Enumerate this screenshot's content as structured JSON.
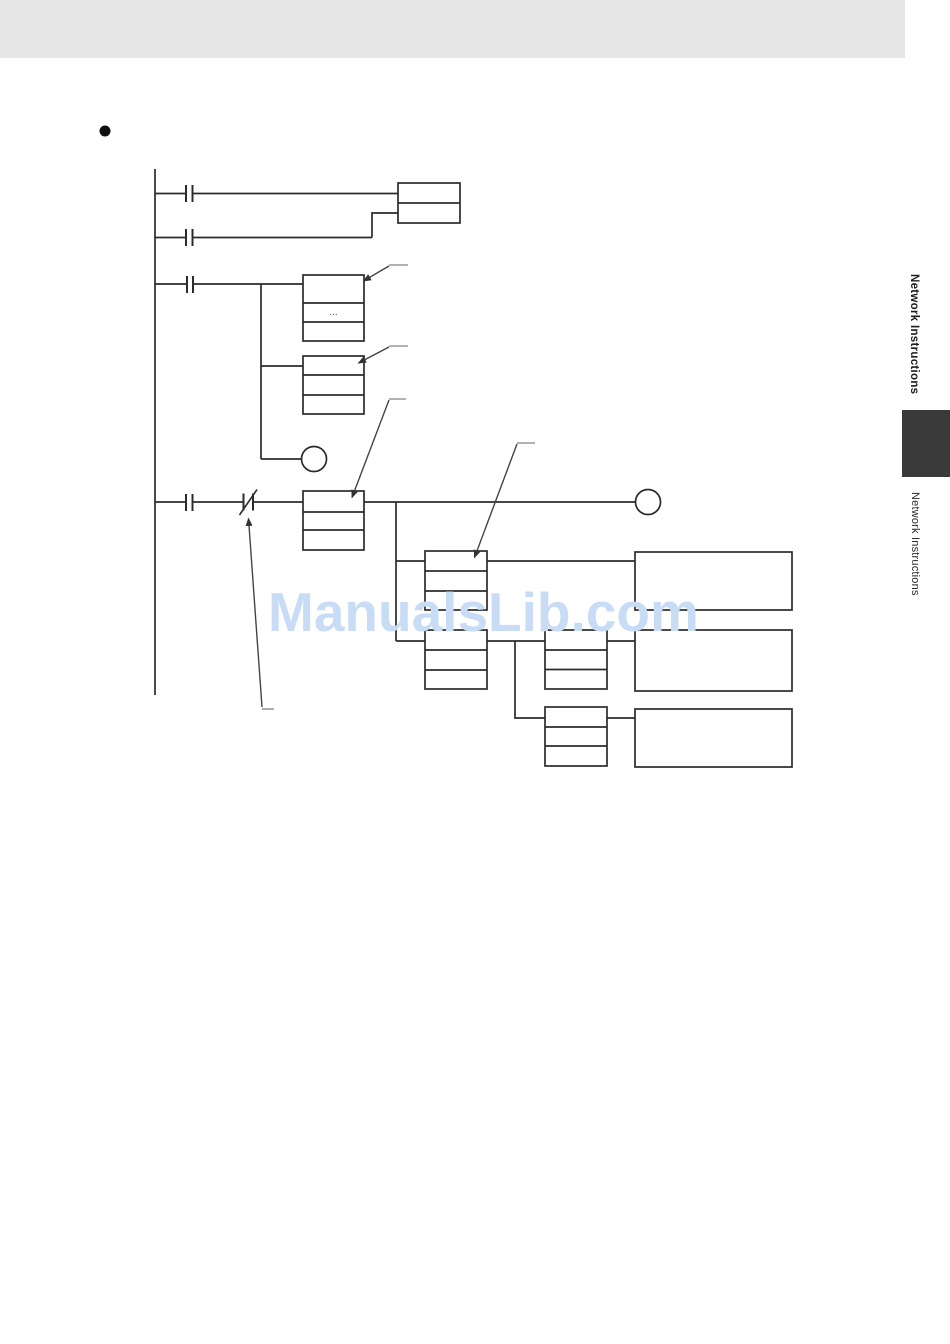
{
  "document": {
    "watermark": "ManualsLib.com",
    "sidebar": {
      "chapter_title": "Network Instructions",
      "running_title": "Network Instructions"
    },
    "diagram": {
      "ellipsis": "..."
    },
    "colors": {
      "header_band": "#e6e6e6",
      "chapter_tab": "#3a3a3a",
      "watermark": "#c9dcf5",
      "diagram_line": "#2b2b2b",
      "callout_tick": "#999999",
      "callout_line": "#444444"
    }
  }
}
